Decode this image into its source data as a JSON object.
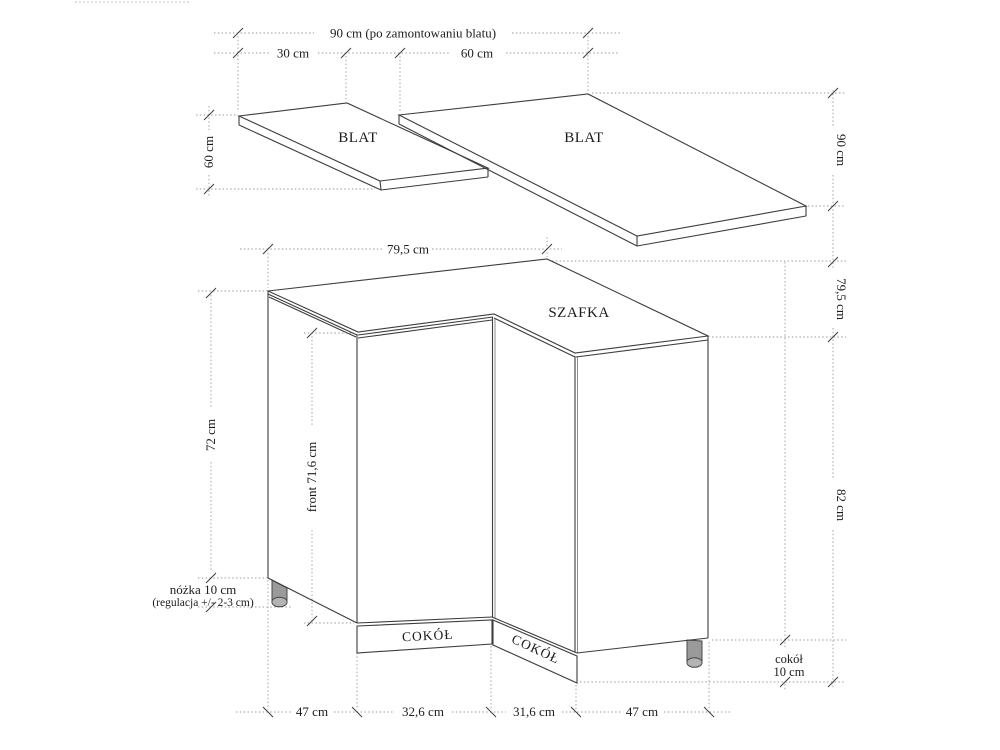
{
  "drawing": {
    "labels": {
      "countertop_left": "BLAT",
      "countertop_right": "BLAT",
      "cabinet": "SZAFKA",
      "plinth_left": "COKÓŁ",
      "plinth_right": "COKÓŁ"
    },
    "dimensions": {
      "top_total": "90 cm (po zamontowaniu blatu)",
      "top_left_segment": "30 cm",
      "top_right_segment": "60 cm",
      "countertop_left_depth": "60 cm",
      "countertop_right_depth": "90 cm",
      "cabinet_width": "79,5 cm",
      "cabinet_depth": "79,5 cm",
      "cabinet_height_left": "72 cm",
      "front_height": "front 71,6 cm",
      "total_height_right": "82 cm",
      "leg_note_line1": "nóżka 10 cm",
      "leg_note_line2": "(regulacja +/- 2-3 cm)",
      "plinth_note_line1": "cokół",
      "plinth_note_line2": "10 cm",
      "bottom_segments": [
        "47 cm",
        "32,6 cm",
        "31,6 cm",
        "47 cm"
      ]
    },
    "colors": {
      "line": "#3d3d3d",
      "guide": "#9b9b9b",
      "leg_fill": "#9a9a9a",
      "background": "#ffffff",
      "text": "#1c1c1c"
    }
  }
}
